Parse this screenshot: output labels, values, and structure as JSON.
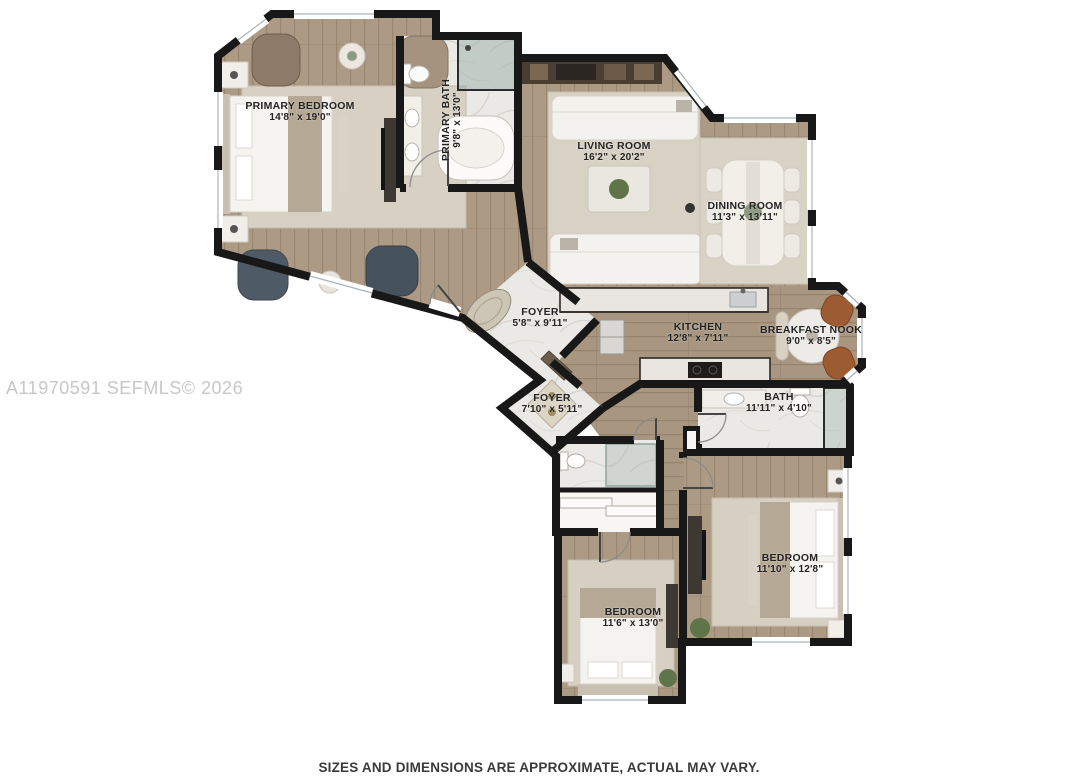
{
  "page": {
    "watermark": "A11970591 SEFMLS© 2026",
    "disclaimer": "SIZES AND DIMENSIONS ARE APPROXIMATE, ACTUAL MAY VARY."
  },
  "floorplan": {
    "rooms": [
      {
        "id": "primary-bedroom",
        "name": "PRIMARY BEDROOM",
        "dims": "14'8\" x 19'0\""
      },
      {
        "id": "primary-bath",
        "name": "PRIMARY BATH",
        "dims": "9'8\" x 13'0\""
      },
      {
        "id": "living-room",
        "name": "LIVING ROOM",
        "dims": "16'2\" x 20'2\""
      },
      {
        "id": "dining-room",
        "name": "DINING ROOM",
        "dims": "11'3\" x 13'11\""
      },
      {
        "id": "foyer-main",
        "name": "FOYER",
        "dims": "5'8\" x 9'11\""
      },
      {
        "id": "kitchen",
        "name": "KITCHEN",
        "dims": "12'8\" x 7'11\""
      },
      {
        "id": "breakfast-nook",
        "name": "BREAKFAST NOOK",
        "dims": "9'0\" x 8'5\""
      },
      {
        "id": "foyer-hall",
        "name": "FOYER",
        "dims": "7'10\" x 5'11\""
      },
      {
        "id": "bath",
        "name": "BATH",
        "dims": "11'11\" x 4'10\""
      },
      {
        "id": "bedroom-2",
        "name": "BEDROOM",
        "dims": "11'10\" x 12'8\""
      },
      {
        "id": "bedroom-3",
        "name": "BEDROOM",
        "dims": "11'6\" x 13'0\""
      }
    ]
  },
  "colors": {
    "wall": "#181818",
    "wood_floor": "#ac9a85",
    "marble_floor": "#ebe9e5",
    "rug": "#d7d0c3",
    "leather_chair": "#9c5b31",
    "navy_chair": "#4e5a66",
    "plant": "#5f7449",
    "watermark_text": "#c7c7c7",
    "disclaimer_text": "#3a3a3a"
  }
}
